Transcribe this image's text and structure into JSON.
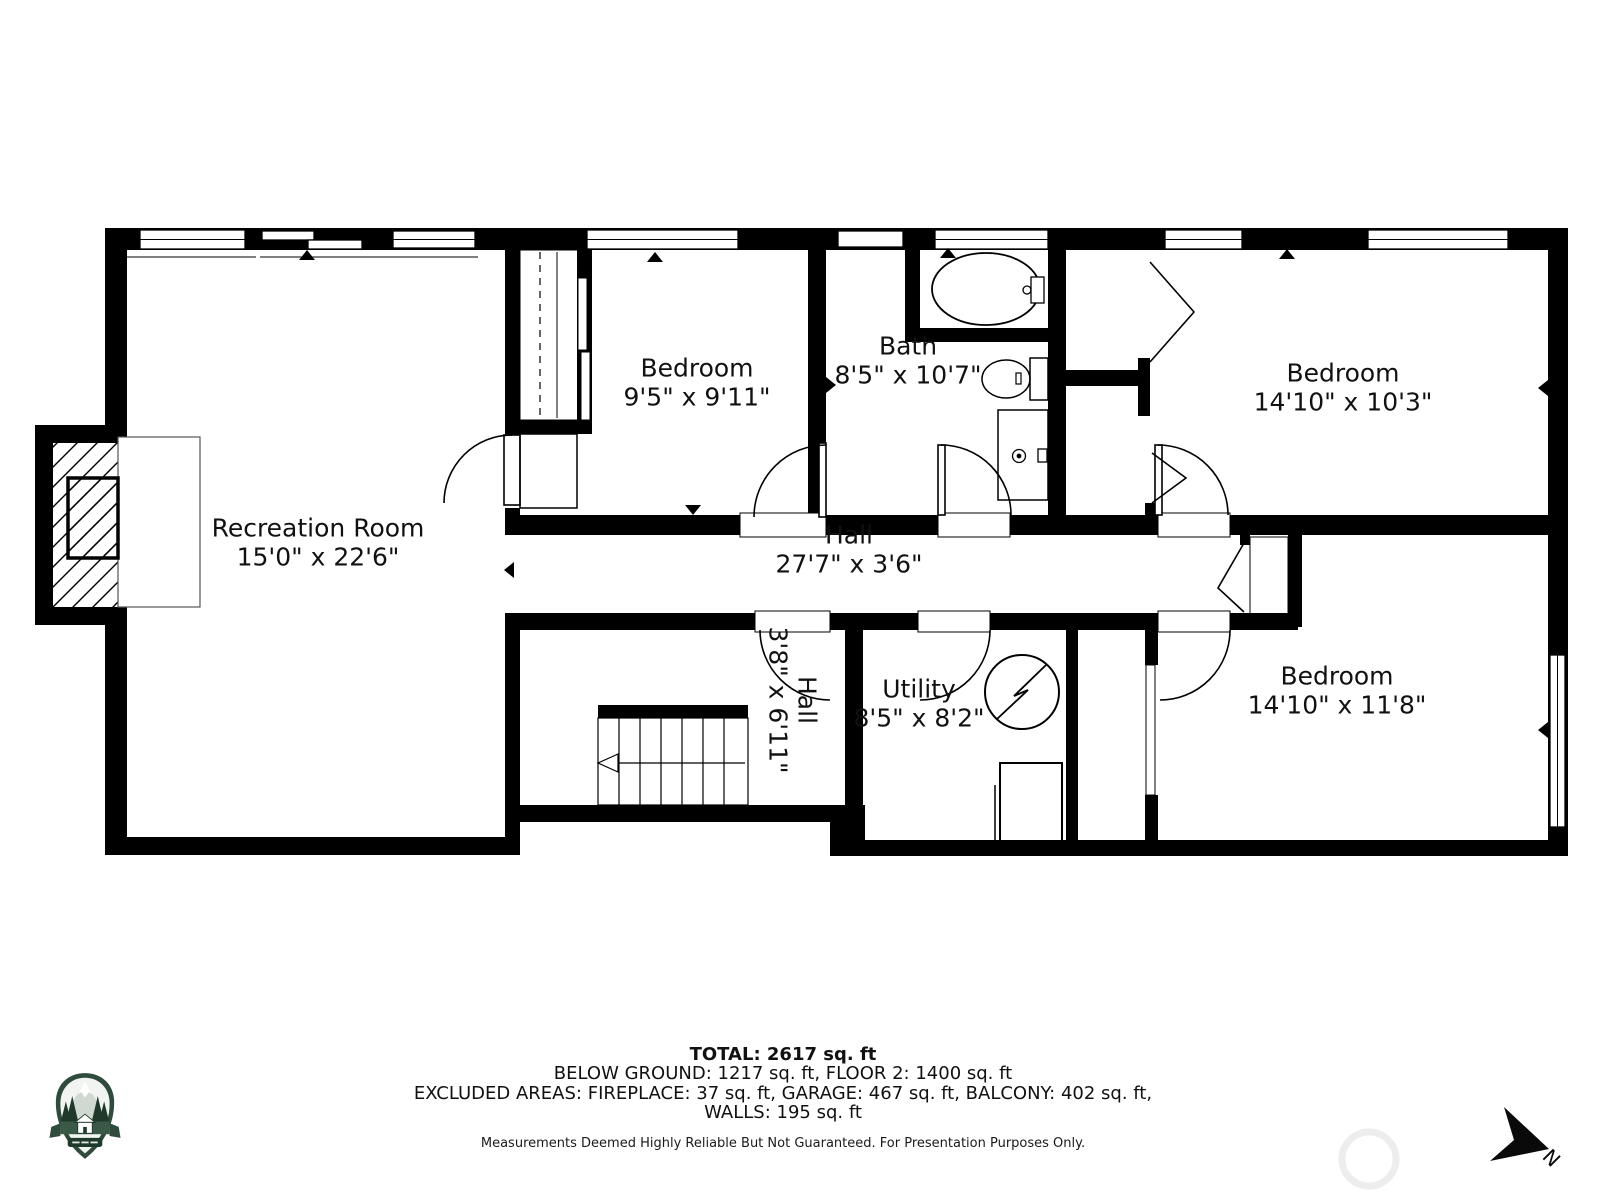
{
  "rooms": {
    "recreation": {
      "name": "Recreation Room",
      "dims": "15'0\" x 22'6\""
    },
    "bedroom1": {
      "name": "Bedroom",
      "dims": "9'5\" x 9'11\""
    },
    "bath": {
      "name": "Bath",
      "dims": "8'5\" x 10'7\""
    },
    "bedroom2": {
      "name": "Bedroom",
      "dims": "14'10\" x 10'3\""
    },
    "hall": {
      "name": "Hall",
      "dims": "27'7\" x 3'6\""
    },
    "hall2": {
      "name": "Hall",
      "dims": "3'8\" x 6'11\""
    },
    "utility": {
      "name": "Utility",
      "dims": "8'5\" x 8'2\""
    },
    "bedroom3": {
      "name": "Bedroom",
      "dims": "14'10\" x 11'8\""
    }
  },
  "summary": {
    "total": "TOTAL: 2617 sq. ft",
    "line1": "BELOW GROUND: 1217 sq. ft, FLOOR 2: 1400 sq. ft",
    "line2": "EXCLUDED AREAS: FIREPLACE: 37 sq. ft, GARAGE: 467 sq. ft, BALCONY: 402 sq. ft,",
    "line3": "WALLS: 195 sq. ft",
    "disclaimer": "Measurements Deemed Highly Reliable But Not Guaranteed. For Presentation Purposes Only."
  },
  "compass": {
    "label": "N"
  },
  "icons": {
    "logo": "mountain-cabin-badge-icon",
    "compass": "north-arrow-icon",
    "watermark": "watermark-circle-icon"
  },
  "colors": {
    "walls": "#000000",
    "background": "#ffffff",
    "logo_green": "#2e4b3b",
    "logo_dark_green": "#1f3a2b"
  }
}
